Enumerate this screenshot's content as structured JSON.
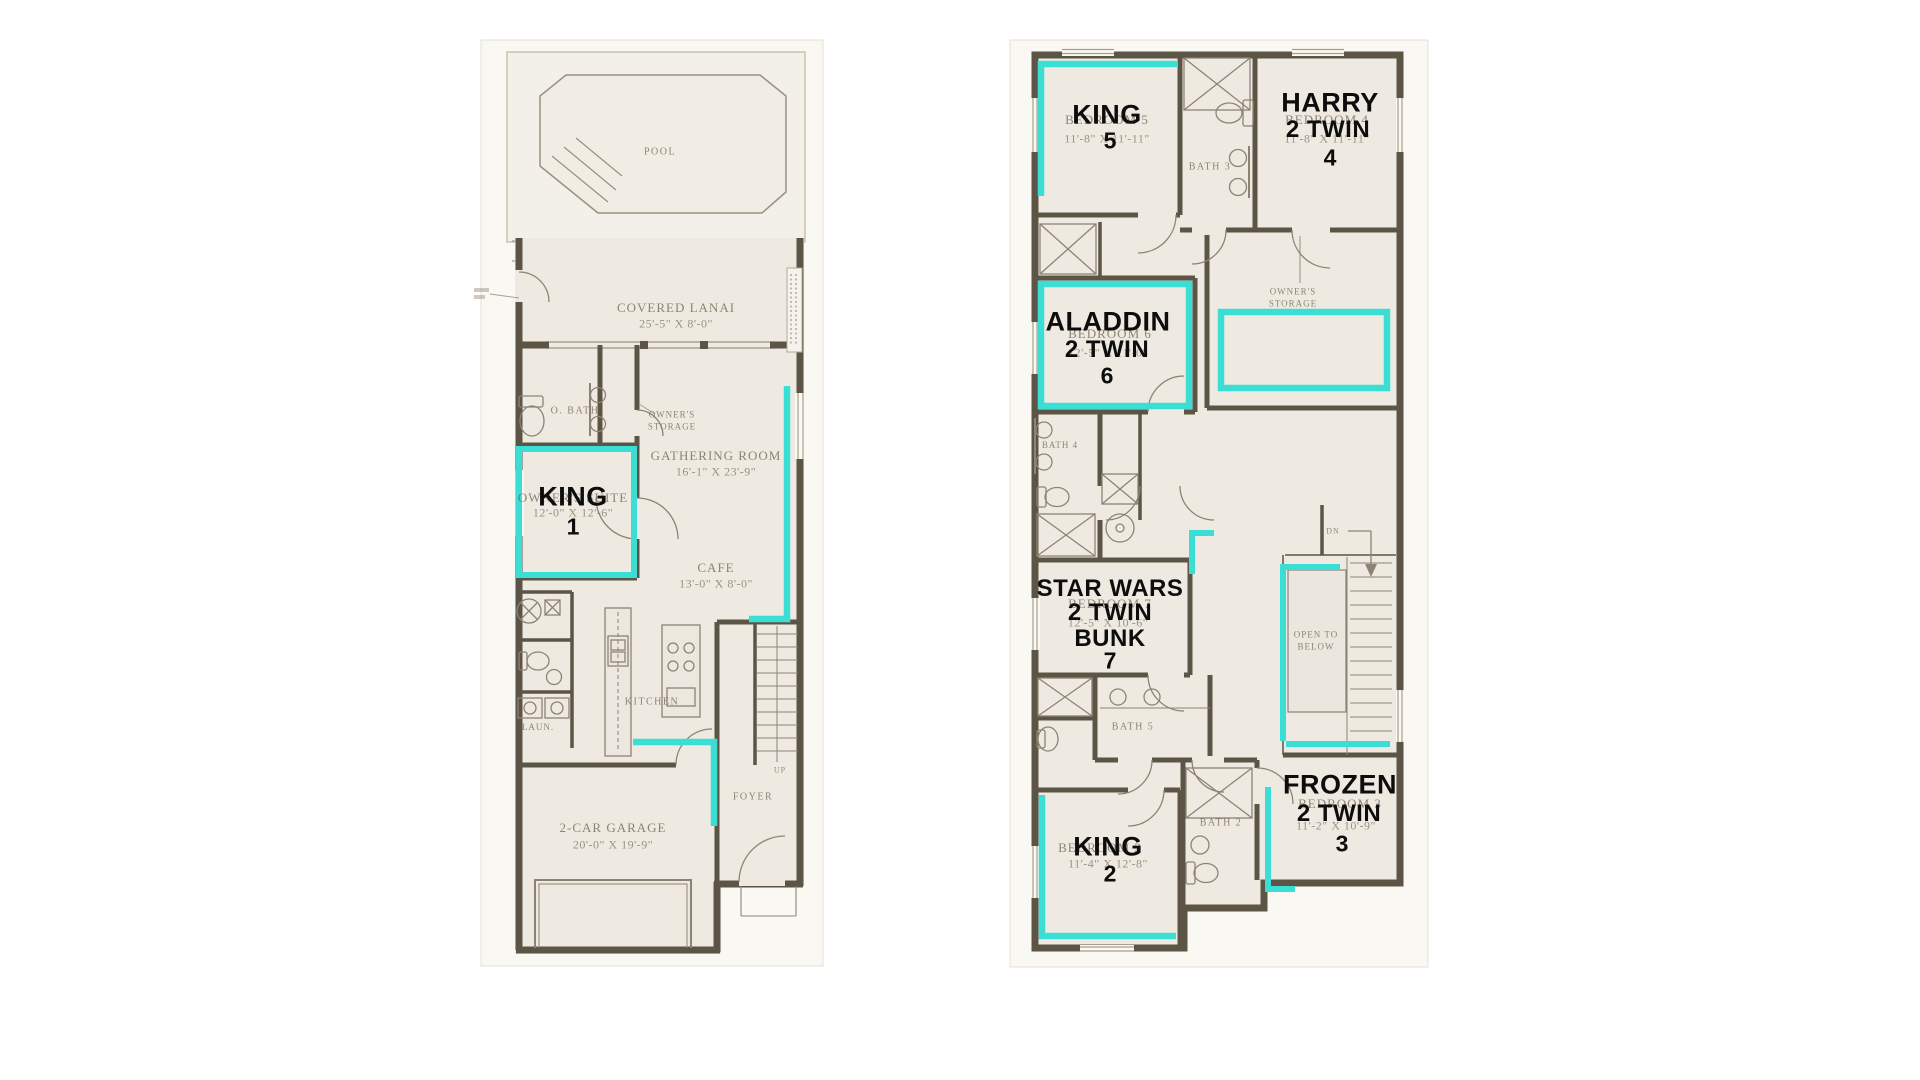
{
  "colors": {
    "highlight": "#3BDED4",
    "wall": "#5C5546",
    "paper": "#EFEAE1",
    "faint_label": "#7C715F",
    "overlay_label": "#0D0D0D"
  },
  "first_floor": {
    "pool": {
      "label": "POOL"
    },
    "lanai": {
      "label": "COVERED LANAI",
      "dims": "25'-5\" X 8'-0\""
    },
    "owners_bath": {
      "label": "O. BATH"
    },
    "owners_storage": {
      "line1": "OWNER'S",
      "line2": "STORAGE"
    },
    "gathering": {
      "label": "GATHERING ROOM",
      "dims": "16'-1\" X 23'-9\""
    },
    "owners_suite": {
      "label": "OWNER'S SUITE",
      "dims": "12'-0\" X 12'-6\"",
      "highlight": "KING",
      "number": "1"
    },
    "cafe": {
      "label": "CAFE",
      "dims": "13'-0\" X 8'-0\""
    },
    "kitchen": {
      "label": "KITCHEN"
    },
    "laundry": {
      "label": "LAUN."
    },
    "stairs": {
      "label": "UP"
    },
    "foyer": {
      "label": "FOYER"
    },
    "garage": {
      "label": "2-CAR GARAGE",
      "dims": "20'-0\" X 19'-9\""
    }
  },
  "second_floor": {
    "bedroom5": {
      "label": "BEDROOM 5",
      "dims": "11'-8\" X 11'-11\"",
      "highlight": "KING",
      "number": "5"
    },
    "bath3": {
      "label": "BATH 3"
    },
    "bedroom4": {
      "label": "BEDROOM 4",
      "dims": "11'-8\" X 11'-11\"",
      "highlight1": "HARRY",
      "highlight2": "2 TWIN",
      "number": "4"
    },
    "owners_storage": {
      "line1": "OWNER'S",
      "line2": "STORAGE"
    },
    "bedroom6": {
      "label": "BEDROOM 6",
      "dims": "12'-5\" X 11'-0\"",
      "highlight1": "ALADDIN",
      "highlight2": "2 TWIN",
      "number": "6"
    },
    "bath4": {
      "label": "BATH 4"
    },
    "bedroom7": {
      "label": "BEDROOM 7",
      "dims": "12'-5\" X 10'-6\"",
      "highlight1": "STAR WARS",
      "highlight2": "2 TWIN",
      "highlight3": "BUNK",
      "number": "7"
    },
    "stairs": {
      "label": "DN"
    },
    "open_to_below": {
      "line1": "OPEN TO",
      "line2": "BELOW"
    },
    "bath5": {
      "label": "BATH 5"
    },
    "bath2": {
      "label": "BATH 2"
    },
    "bedroom3": {
      "label": "BEDROOM 3",
      "dims": "11'-2\" X 10'-9\"",
      "highlight1": "FROZEN",
      "highlight2": "2 TWIN",
      "number": "3"
    },
    "bedroom2": {
      "label": "BEDROOM 2",
      "dims": "11'-4\" X 12'-8\"",
      "highlight": "KING",
      "number": "2"
    }
  }
}
